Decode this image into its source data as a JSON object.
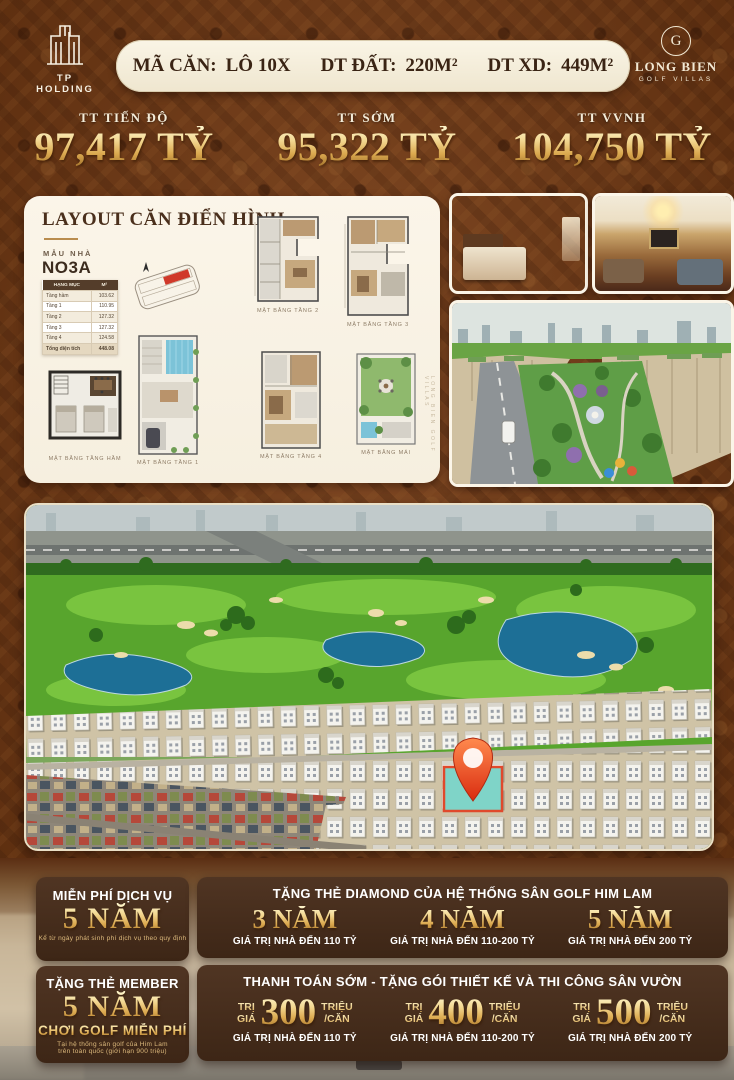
{
  "header": {
    "brand_left": "TP HOLDING",
    "brand_right_name": "LONG BIEN",
    "brand_right_sub": "GOLF VILLAS",
    "brand_right_monogram": "G",
    "unit_bar": {
      "code_label": "MÃ CĂN:",
      "code_value": "LÔ 10X",
      "land_label": "DT ĐẤT:",
      "land_value": "220M²",
      "build_label": "DT XD:",
      "build_value": "449M²"
    }
  },
  "prices": {
    "p1_label": "TT TIẾN ĐỘ",
    "p1_value": "97,417 TỶ",
    "p2_label": "TT SỚM",
    "p2_value": "95,322 TỶ",
    "p3_label": "TT VVNH",
    "p3_value": "104,750 TỶ"
  },
  "layout_panel": {
    "title": "LAYOUT CĂN ĐIỂN HÌNH",
    "model_label": "MẪU NHÀ",
    "model_name": "NO3A",
    "table": {
      "col1": "HẠNG MỤC",
      "col2": "M²",
      "rows": [
        [
          "Tầng hầm",
          "103.62"
        ],
        [
          "Tầng 1",
          "110.95"
        ],
        [
          "Tầng 2",
          "127.32"
        ],
        [
          "Tầng 3",
          "127.32"
        ],
        [
          "Tầng 4",
          "124.58"
        ]
      ],
      "total_label": "Tổng diện tích",
      "total_value": "448.08"
    },
    "captions": {
      "floor2": "MẶT BẰNG TẦNG 2",
      "floor3": "MẶT BẰNG TẦNG 3",
      "basement": "MẶT BẰNG TẦNG HẦM",
      "floor1": "MẶT BẰNG TẦNG 1",
      "floor4": "MẶT BẰNG TẦNG 4",
      "roof": "MẶT BẰNG MÁI"
    },
    "watermark": "LONG BIEN GOLF VILLAS"
  },
  "promos": {
    "service_free": {
      "title": "MIỄN PHÍ DỊCH VỤ",
      "term": "5 NĂM",
      "note": "Kể từ ngày phát sinh phí dịch vụ theo quy định"
    },
    "member_card": {
      "title": "TẶNG THẺ MEMBER",
      "term": "5 NĂM",
      "subtitle": "CHƠI GOLF MIỄN PHÍ",
      "note1": "Tại hệ thống sân golf của Him Lam",
      "note2": "trên toàn quốc (giới hạn 900 triệu)"
    },
    "diamond_card": {
      "title": "TẶNG THẺ DIAMOND CỦA HỆ THỐNG SÂN GOLF HIM LAM",
      "tiers": [
        {
          "term": "3 NĂM",
          "condition": "GIÁ TRỊ NHÀ ĐẾN 110 TỶ"
        },
        {
          "term": "4 NĂM",
          "condition": "GIÁ TRỊ NHÀ ĐẾN 110-200 TỶ"
        },
        {
          "term": "5 NĂM",
          "condition": "GIÁ TRỊ NHÀ ĐẾN 200 TỶ"
        }
      ]
    },
    "early_payment": {
      "title": "THANH TOÁN SỚM - TẶNG GÓI THIẾT KẾ VÀ THI CÔNG SÂN VƯỜN",
      "tiers": [
        {
          "prefix_top": "TRỊ",
          "prefix_bottom": "GIÁ",
          "amount": "300",
          "suffix_top": "TRIỆU",
          "suffix_bottom": "/CĂN",
          "condition": "GIÁ TRỊ NHÀ ĐẾN 110 TỶ"
        },
        {
          "prefix_top": "TRỊ",
          "prefix_bottom": "GIÁ",
          "amount": "400",
          "suffix_top": "TRIỆU",
          "suffix_bottom": "/CĂN",
          "condition": "GIÁ TRỊ NHÀ ĐẾN 110-200 TỶ"
        },
        {
          "prefix_top": "TRỊ",
          "prefix_bottom": "GIÁ",
          "amount": "500",
          "suffix_top": "TRIỆU",
          "suffix_bottom": "/CĂN",
          "condition": "GIÁ TRỊ NHÀ ĐẾN 200 TỶ"
        }
      ]
    }
  },
  "colors": {
    "background_brown": "#6f3c1d",
    "gold": "#e3bc62",
    "promo_box_brown": "#44291c",
    "cream": "#f5eedb",
    "pin_red": "#e8421f",
    "highlight_teal": "#7fd4c8"
  }
}
